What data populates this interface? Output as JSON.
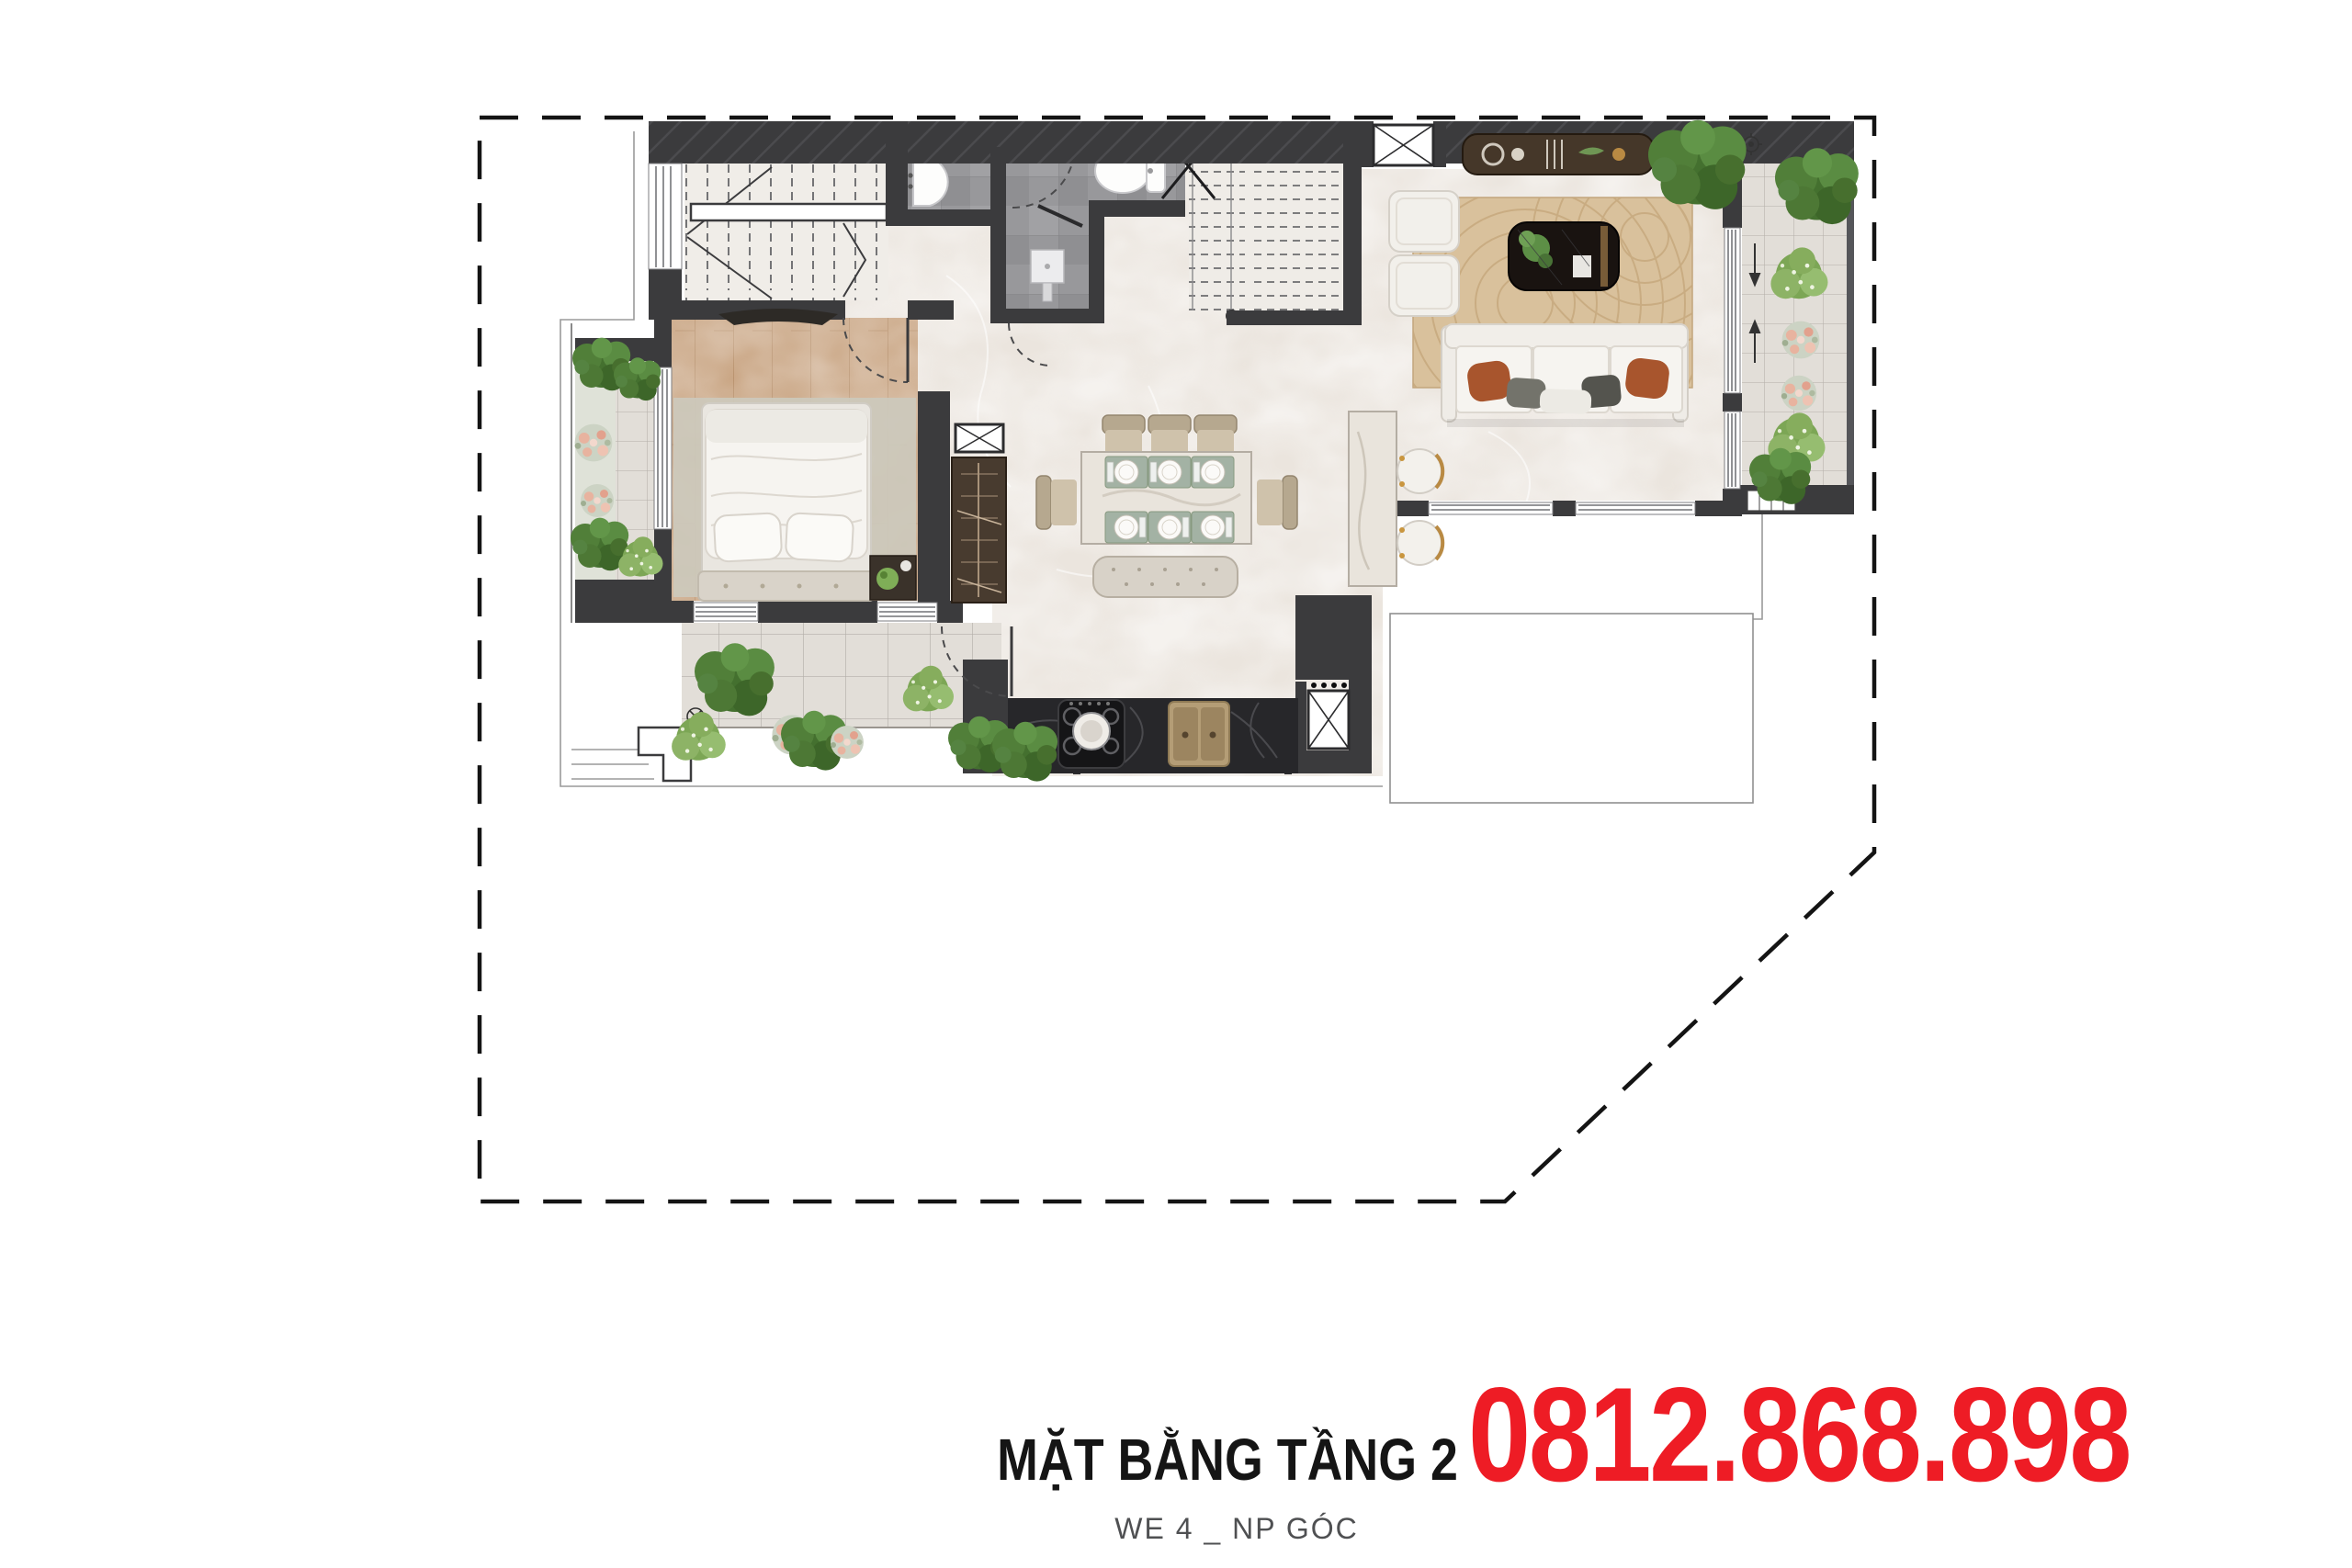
{
  "footer": {
    "title": "MẶT BẰNG TẦNG 2",
    "subtitle": "WE 4 _ NP GÓC",
    "phone": "0812.868.898"
  },
  "plan": {
    "type": "apartment-floor-plan",
    "level_shown": "2",
    "unit_code_shown": "WE 4 _ NP GÓC"
  },
  "colors": {
    "phone_red": "#ee1c25",
    "title_black": "#151515",
    "subtitle_gray": "#4f5052",
    "wall_dark": "#3b3b3d",
    "marble": "#ebe5de",
    "tile": "#e2ded8",
    "bath_gray": "#98989b",
    "wood": "#c9a583",
    "rug_tan": "#d9c19c",
    "counter_black": "#27272a",
    "plant_green": "#517f39",
    "boundary_black": "#141414"
  },
  "icons": {
    "boundary": "dashed-property-line-icon",
    "door_swing": "door-arc-icon",
    "stairs": "stair-treads-icon",
    "shaft": "crossed-box-icon"
  }
}
